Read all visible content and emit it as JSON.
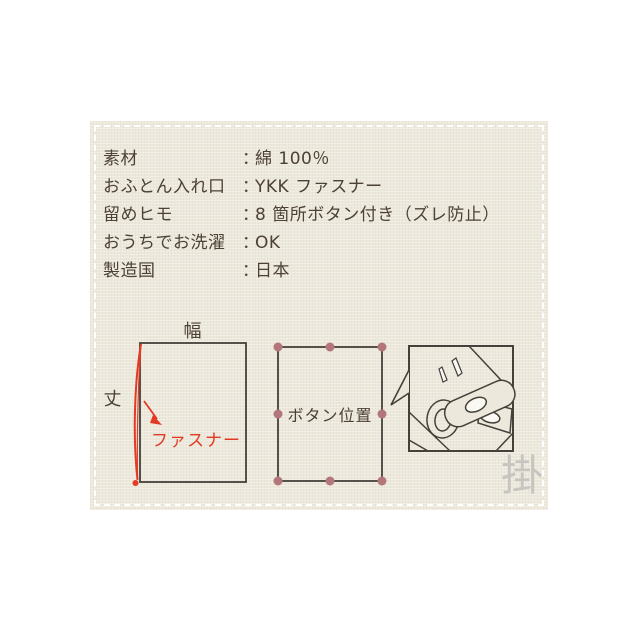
{
  "specs": {
    "colon": "：",
    "rows": [
      {
        "label": "素材",
        "value": "綿 100％"
      },
      {
        "label": "おふとん入れ口",
        "value": "YKK ファスナー"
      },
      {
        "label": "留めヒモ",
        "value": "8 箇所ボタン付き（ズレ防止）"
      },
      {
        "label": "おうちでお洗濯",
        "value": "OK"
      },
      {
        "label": "製造国",
        "value": "日本"
      }
    ]
  },
  "diagrams": {
    "size_diagram": {
      "width_label": "幅",
      "height_label": "丈",
      "zipper_label": "ファスナー"
    },
    "button_diagram": {
      "label": "ボタン位置",
      "button_count": 8
    },
    "detail_diagram": {
      "description": "button-and-loop-closeup"
    }
  },
  "watermark": {
    "character": "掛"
  },
  "colors": {
    "page_background": "#ffffff",
    "card_background": "#ece8dc",
    "text": "#4d4136",
    "line": "#45403a",
    "accent_red": "#e23a24",
    "button_dot": "#b3767b",
    "watermark": "#c7c5bf",
    "dashed_border": "#ffffff"
  }
}
